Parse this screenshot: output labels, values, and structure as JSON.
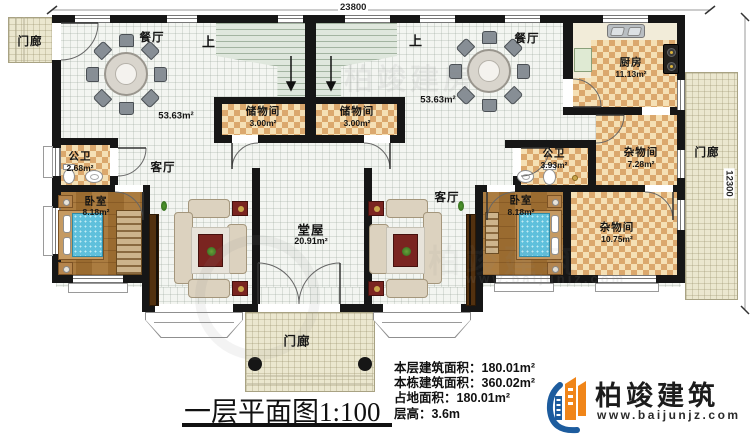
{
  "dimensions": {
    "top": "23800",
    "right": "12300"
  },
  "rooms": {
    "porch_top_left": {
      "label": "门廊"
    },
    "porch_right": {
      "label": "门廊"
    },
    "porch_bottom": {
      "label": "门廊"
    },
    "dining_left": {
      "label": "餐厅",
      "area": "53.63m²"
    },
    "dining_right": {
      "label": "餐厅",
      "area": "53.63m²"
    },
    "stairs_left": {
      "label": "上"
    },
    "stairs_right": {
      "label": "上"
    },
    "storage_left": {
      "label": "储物间",
      "area": "3.00m²"
    },
    "storage_right": {
      "label": "储物间",
      "area": "3.00m²"
    },
    "kitchen": {
      "label": "厨房",
      "area": "11.13m²"
    },
    "bath_left": {
      "label": "公卫",
      "area": "2.68m²"
    },
    "bath_right": {
      "label": "公卫",
      "area": "3.93m²"
    },
    "living_left": {
      "label": "客厅"
    },
    "living_right": {
      "label": "客厅"
    },
    "bedroom_left": {
      "label": "卧室",
      "area": "8.18m²"
    },
    "bedroom_right": {
      "label": "卧室",
      "area": "8.18m²"
    },
    "utility_upper": {
      "label": "杂物间",
      "area": "7.28m²"
    },
    "utility_lower": {
      "label": "杂物间",
      "area": "10.75m²"
    },
    "hall": {
      "label": "堂屋",
      "area": "20.91m²"
    }
  },
  "footer": {
    "title": "一层平面图",
    "scale": "1:100",
    "stats": [
      {
        "label": "本层建筑面积：",
        "value": "180.01m²"
      },
      {
        "label": "本栋建筑面积：",
        "value": "360.02m²"
      },
      {
        "label": "占地面积：",
        "value": "180.01m²"
      },
      {
        "label": "层高：",
        "value": "3.6m"
      }
    ]
  },
  "brand": {
    "name": "柏竣建筑",
    "url": "www.baijunjz.com"
  },
  "watermarks": {
    "text1": "柏竣建房",
    "text2": "柏竣建筑",
    "url": "www.baijunjz.com"
  },
  "colors": {
    "wall": "#161616",
    "checker_dark": "#dba86d",
    "checker_light": "#f5e0b5",
    "wood": "#a5793f",
    "tile": "#f3f5f1",
    "porch": "#ebe7cf",
    "stair": "#dfe7dd",
    "bed": "#5fc0dc",
    "accent_red": "#7a2420",
    "brand_orange": "#f08519",
    "brand_blue": "#1d5c9e"
  }
}
